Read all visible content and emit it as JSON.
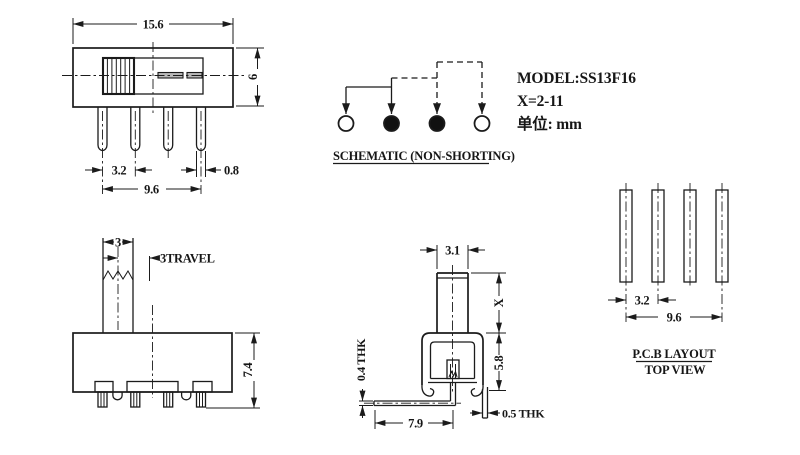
{
  "drawing": {
    "title_block": {
      "model": "MODEL:SS13F16",
      "x_range": "X=2-11",
      "units": "单位: mm"
    },
    "schematic": {
      "label": "SCHEMATIC (NON-SHORTING)",
      "terminals": [
        "open",
        "filled",
        "filled",
        "open"
      ]
    },
    "front_view": {
      "width_label": "15.6",
      "height_label": "6",
      "pin_pitch_label": "3.2",
      "pin_width_label": "0.8",
      "pin_span_label": "9.6"
    },
    "side_view": {
      "knob_width_label": "3",
      "travel_label": "3TRAVEL",
      "height_label": "7.4"
    },
    "section_view": {
      "knob_width_label": "3.1",
      "knob_height_label": "X",
      "body_height_label": "5.8",
      "plate_thickness_label": "0.4 THK",
      "plate_length_label": "7.9",
      "terminal_thickness_label": "0.5 THK"
    },
    "pcb_layout": {
      "title": "P.C.B LAYOUT",
      "subtitle": "TOP VIEW",
      "pad_pitch_label": "3.2",
      "pad_span_label": "9.6"
    },
    "colors": {
      "line": "#1b1b1b",
      "background": "#ffffff",
      "slot_fill": "#b9b9b9",
      "terminal_filled": "#111111"
    }
  }
}
